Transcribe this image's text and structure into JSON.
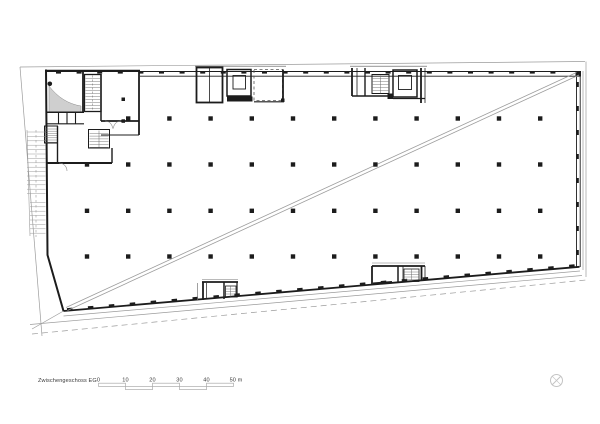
{
  "plan": {
    "title": "Zwischengeschoss EG"
  },
  "scale_bar": {
    "labels": [
      "0",
      "10",
      "20",
      "30",
      "40",
      "50 m"
    ]
  },
  "icons": {
    "north_arrow": "crossed-circle"
  },
  "colors": {
    "ink": "#1c1c1c",
    "line_gray": "#9c9c9c",
    "light_gray": "#c4c4c4",
    "ramp_fill": "#cfcfcf",
    "paper": "#ffffff"
  }
}
